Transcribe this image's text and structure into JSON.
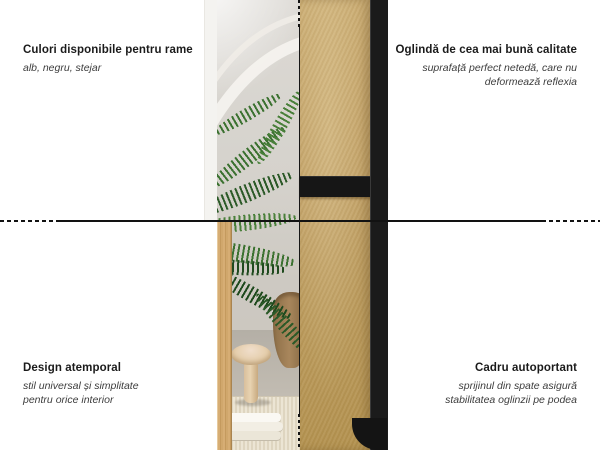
{
  "annotations": {
    "top_left": {
      "title": "Culori disponibile pentru rame",
      "subtitle": "alb, negru, stejar"
    },
    "top_right": {
      "title": "Oglindă de cea mai bună calitate",
      "subtitle_line1": "suprafață perfect netedă, care nu",
      "subtitle_line2": "deformează reflexia"
    },
    "bottom_left": {
      "title": "Design atemporal",
      "subtitle_line1": "stil universal și simplitate",
      "subtitle_line2": "pentru orice interior"
    },
    "bottom_right": {
      "title": "Cadru autoportant",
      "subtitle_line1": "sprijinul din spate asigură",
      "subtitle_line2": "stabilitatea oglinzii pe podea"
    }
  },
  "colors": {
    "frame_black": "#1b1b1b",
    "frame_oak": "#d0a76c",
    "frame_white": "#f4f3f0",
    "mdf_back_panel": "#c2a267",
    "line_color": "#121212"
  }
}
